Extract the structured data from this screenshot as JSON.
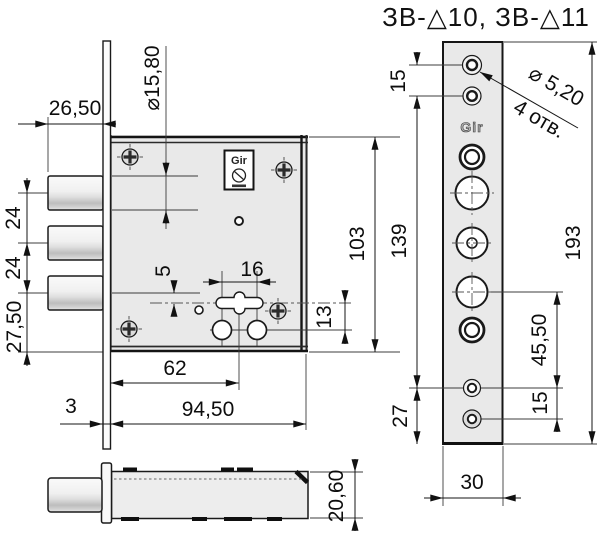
{
  "title": "ЗВ-△10, ЗВ-△11",
  "main_view": {
    "dim_bolt_offset": "26,50",
    "dim_bolt_dia": "⌀15,80",
    "dim_spacing_a": "24",
    "dim_spacing_b": "24",
    "dim_bottom_offset": "27,50",
    "dim_plate_thickness": "3",
    "dim_axis_offset": "5",
    "dim_slot_length": "16",
    "dim_slot_offset": "62",
    "dim_body_width": "94,50",
    "dim_holes_offset": "13",
    "dim_body_height": "103",
    "logo": "Gir"
  },
  "side_view": {
    "dim_case_thickness": "20,60"
  },
  "faceplate_view": {
    "dim_top_holes": "15",
    "hole_note_dia": "⌀ 5,20",
    "hole_note_count": "4 отв.",
    "dim_holes_span": "139",
    "dim_bottom_edge": "27",
    "dim_total_height": "193",
    "dim_lower_span": "45,50",
    "dim_bottom_holes": "15",
    "dim_plate_width": "30",
    "logo": "Gir"
  }
}
